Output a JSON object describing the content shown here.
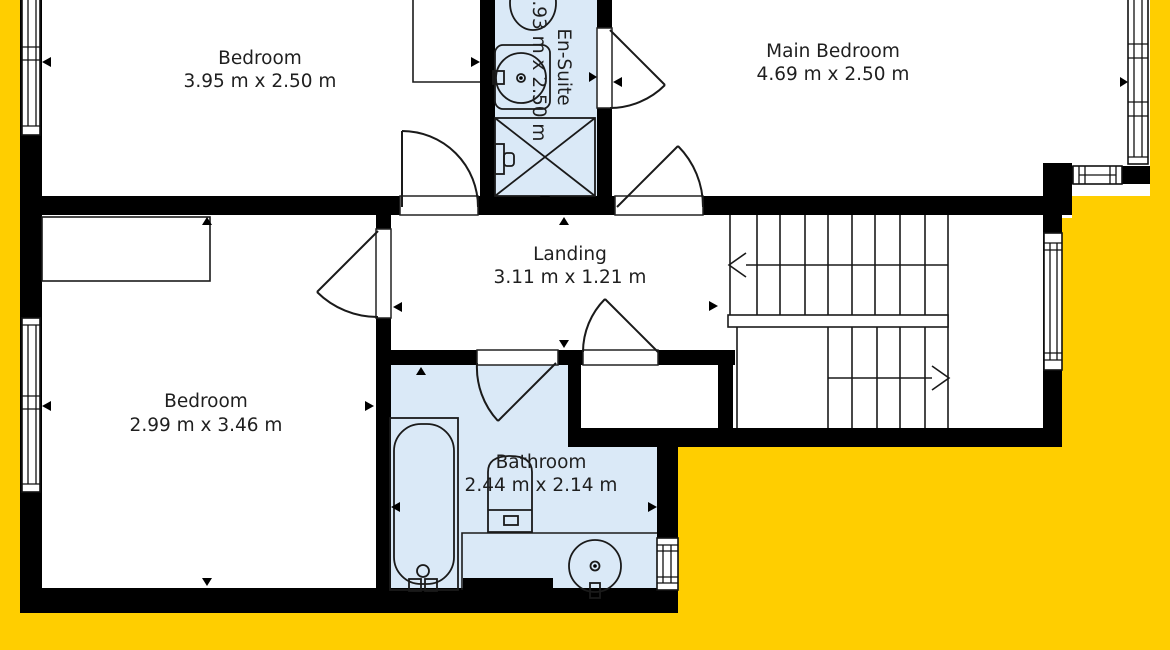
{
  "plan": {
    "background_color": "#FFCE00",
    "floor_color": "#FFFFFF",
    "wet_room_color": "#DAE9F7",
    "wall_color": "#000000",
    "rooms": {
      "bedroom_top": {
        "name": "Bedroom",
        "dims": "3.95 m x 2.50 m"
      },
      "en_suite": {
        "name": "En-Suite",
        "dims": "0.93 m x 2.50 m"
      },
      "main_bedroom": {
        "name": "Main Bedroom",
        "dims": "4.69 m x 2.50 m"
      },
      "landing": {
        "name": "Landing",
        "dims": "3.11 m x 1.21 m"
      },
      "bedroom_bottom": {
        "name": "Bedroom",
        "dims": "2.99 m x 3.46 m"
      },
      "bathroom": {
        "name": "Bathroom",
        "dims": "2.44 m x 2.14 m"
      }
    }
  }
}
